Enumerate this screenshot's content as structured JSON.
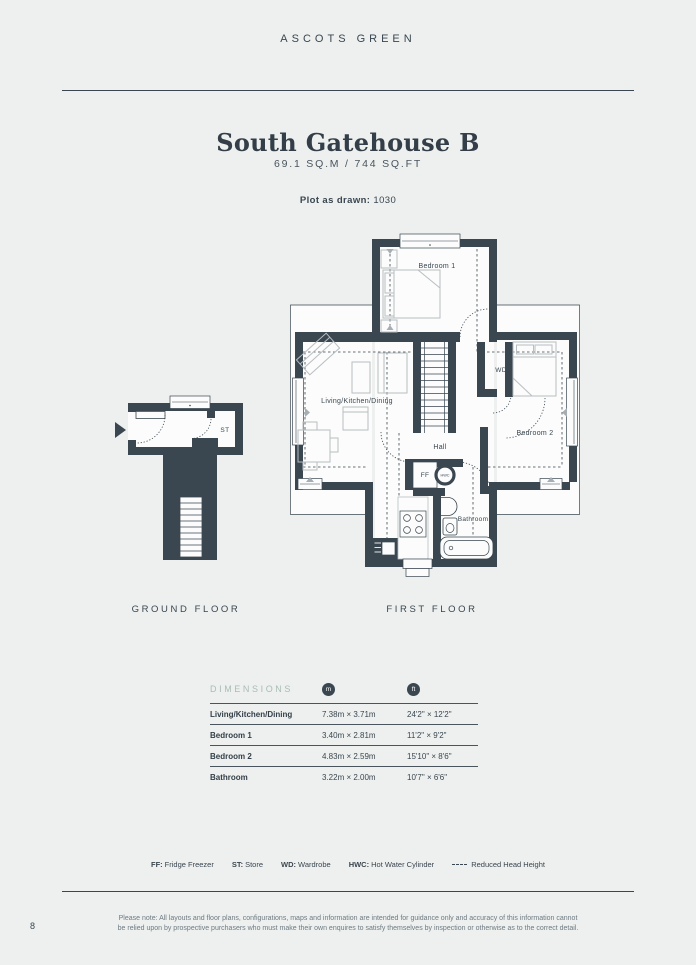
{
  "page": {
    "brand": "ASCOTS GREEN",
    "page_number": "8",
    "title": "South Gatehouse B",
    "area": "69.1 SQ.M / 744 SQ.FT",
    "plot_label": "Plot as drawn:",
    "plot_value": "1030",
    "disclaimer_line1": "Please note: All layouts and floor plans, configurations, maps and information are intended for guidance only and accuracy of this information cannot",
    "disclaimer_line2": "be relied upon by prospective purchasers who must make their own enquires to satisfy themselves by inspection or otherwise as to the correct detail."
  },
  "floors": {
    "ground": {
      "label": "GROUND FLOOR",
      "rooms": {
        "store": "ST"
      }
    },
    "first": {
      "label": "FIRST FLOOR",
      "rooms": {
        "bedroom1": "Bedroom 1",
        "living": "Living/Kitchen/Dining",
        "hall": "Hall",
        "bedroom2": "Bedroom 2",
        "bathroom": "Bathroom",
        "wd": "WD",
        "ff": "FF",
        "hwc": "HWC"
      }
    }
  },
  "dimensions": {
    "heading": "DIMENSIONS",
    "unit_m": "m",
    "unit_ft": "ft",
    "rows": [
      {
        "room": "Living/Kitchen/Dining",
        "metric": "7.38m × 3.71m",
        "imperial": "24'2\" × 12'2\""
      },
      {
        "room": "Bedroom 1",
        "metric": "3.40m × 2.81m",
        "imperial": "11'2\" × 9'2\""
      },
      {
        "room": "Bedroom 2",
        "metric": "4.83m × 2.59m",
        "imperial": "15'10\" × 8'6\""
      },
      {
        "room": "Bathroom",
        "metric": "3.22m × 2.00m",
        "imperial": "10'7\" × 6'6\""
      }
    ]
  },
  "legend": {
    "items": [
      {
        "key": "FF:",
        "value": "Fridge Freezer"
      },
      {
        "key": "ST:",
        "value": "Store"
      },
      {
        "key": "WD:",
        "value": "Wardrobe"
      },
      {
        "key": "HWC:",
        "value": "Hot Water Cylinder"
      },
      {
        "key": "",
        "value": "Reduced Head Height"
      }
    ]
  },
  "colors": {
    "background": "#edf0ee",
    "wall": "#3a4650",
    "accent_sage": "#a9bdb3",
    "furniture": "#b8bec2"
  }
}
